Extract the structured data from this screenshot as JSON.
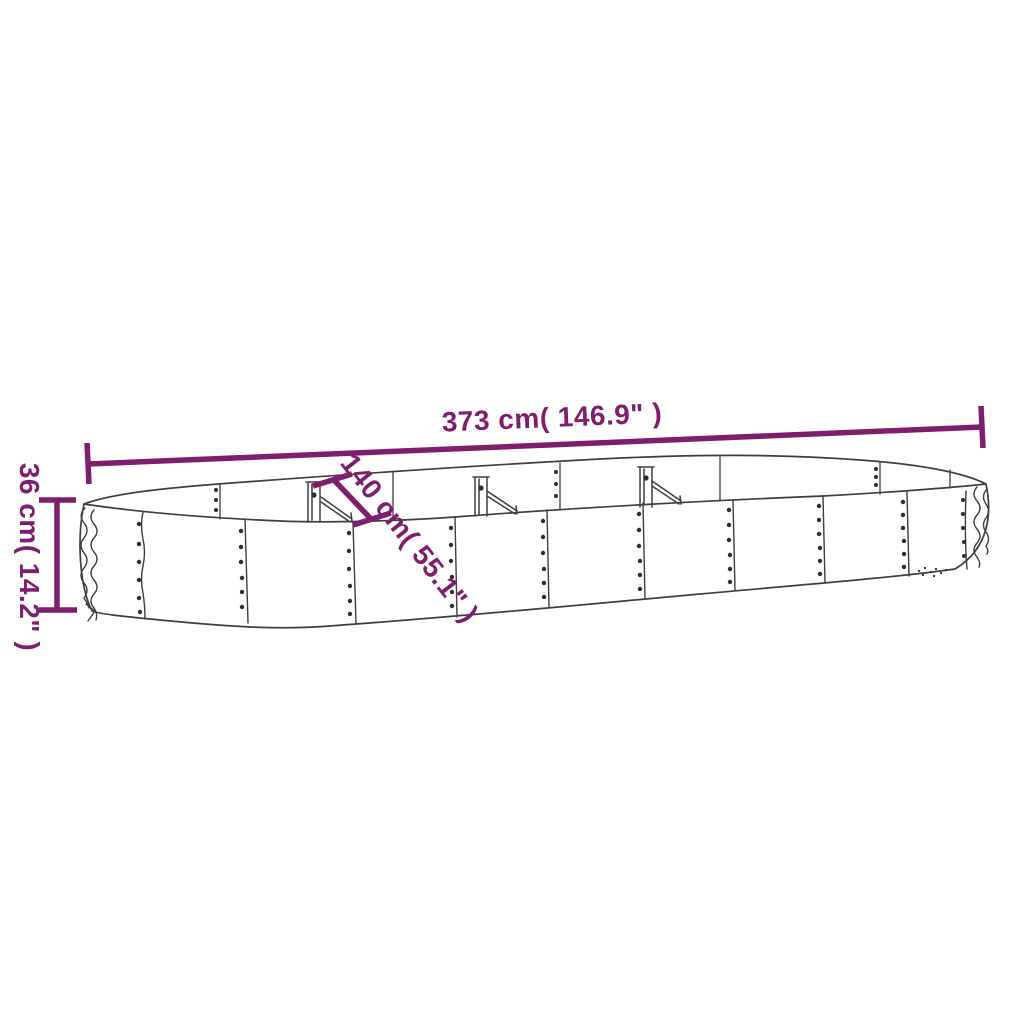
{
  "diagram": {
    "colors": {
      "dimension": "#7f1d6f",
      "outline": "#3f3f3f",
      "rivet": "#2e2e2e",
      "background": "#ffffff"
    },
    "dimensions": {
      "length": {
        "label": "373 cm( 146.9\" )"
      },
      "width": {
        "label": "140 cm( 55.1\" )"
      },
      "height": {
        "label": "36 cm( 14.2\" )"
      }
    }
  }
}
